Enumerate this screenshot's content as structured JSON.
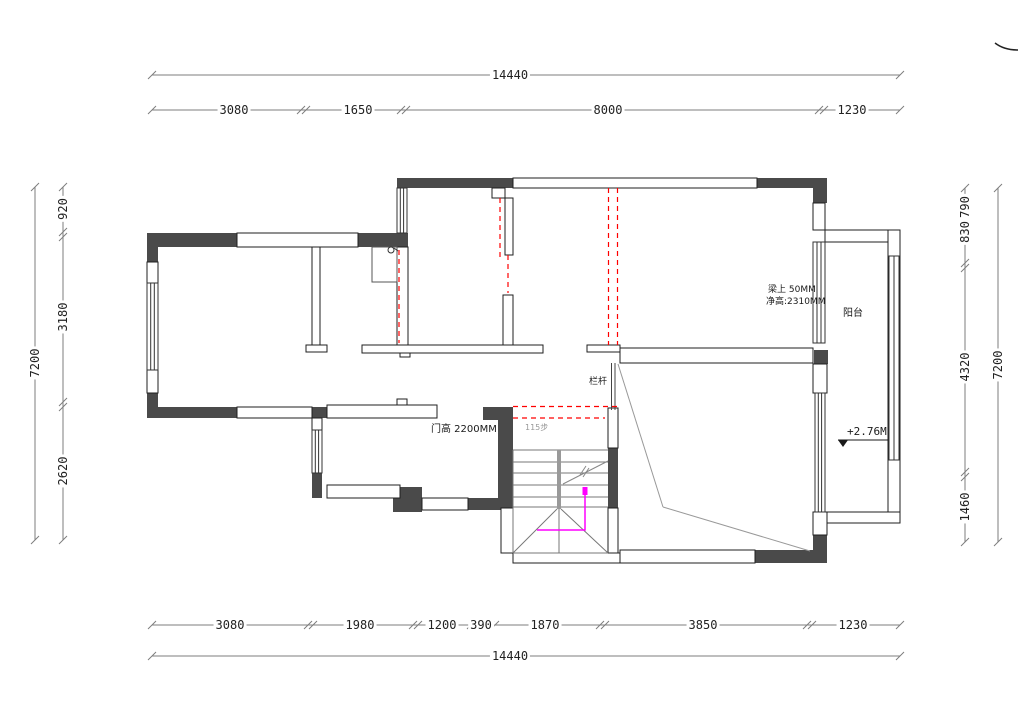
{
  "dims": {
    "top_overall": "14440",
    "top_segments": [
      "3080",
      "1650",
      "8000",
      "1230"
    ],
    "bottom_segments": [
      "3080",
      "1980",
      "1200",
      "390",
      "1870",
      "3850",
      "1230"
    ],
    "bottom_overall": "14440",
    "left_overall": "7200",
    "left_segments": [
      "920",
      "3180",
      "2620"
    ],
    "right_segments": [
      "790",
      "830",
      "4320",
      "1460"
    ],
    "right_overall": "7200"
  },
  "annotations": {
    "beam_note_line1": "梁上 50MM",
    "beam_note_line2": "净高:2310MM",
    "balcony_label": "阳台",
    "level_mark": "+2.76M",
    "door_height_note": "门高 2200MM",
    "stair_steps_note": "115步",
    "railing_label": "栏杆"
  },
  "colors": {
    "wall_fill": "#4a4a4a",
    "demolition_dashed": "#ff0000",
    "stair_route": "#ff00ff",
    "dim_line": "#7d7d7d",
    "diagonal": "#999999"
  }
}
